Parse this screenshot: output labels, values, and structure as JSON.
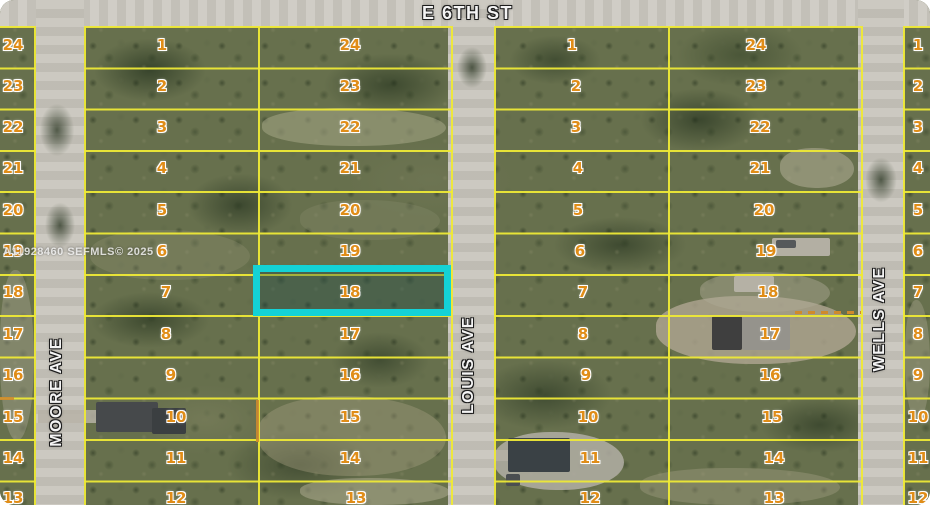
{
  "map": {
    "watermark": "A11928460 SEFMLS© 2025",
    "highlighted_lot": "18",
    "streets": {
      "top": "E 6TH ST",
      "left": "MOORE AVE",
      "middle": "LOUIS AVE",
      "right": "WELLS AVE"
    },
    "colors": {
      "parcel_line": "#eee936",
      "lot_number": "#e08d18",
      "highlight": "#14d2d6",
      "road": "#c9c6bd",
      "terrain": "#67704d"
    }
  },
  "lots": {
    "west": [
      "24",
      "23",
      "22",
      "21",
      "20",
      "19",
      "18",
      "17",
      "16",
      "15",
      "14",
      "13"
    ],
    "block1_left": [
      "1",
      "2",
      "3",
      "4",
      "5",
      "6",
      "7",
      "8",
      "9",
      "10",
      "11",
      "12"
    ],
    "block1_right": [
      "24",
      "23",
      "22",
      "21",
      "20",
      "19",
      "18",
      "17",
      "16",
      "15",
      "14",
      "13"
    ],
    "block2_left": [
      "1",
      "2",
      "3",
      "4",
      "5",
      "6",
      "7",
      "8",
      "9",
      "10",
      "11",
      "12"
    ],
    "block2_right": [
      "24",
      "23",
      "22",
      "21",
      "20",
      "19",
      "18",
      "17",
      "16",
      "15",
      "14",
      "13"
    ],
    "east": [
      "1",
      "2",
      "3",
      "4",
      "5",
      "6",
      "7",
      "8",
      "9",
      "10",
      "11",
      "12"
    ]
  }
}
